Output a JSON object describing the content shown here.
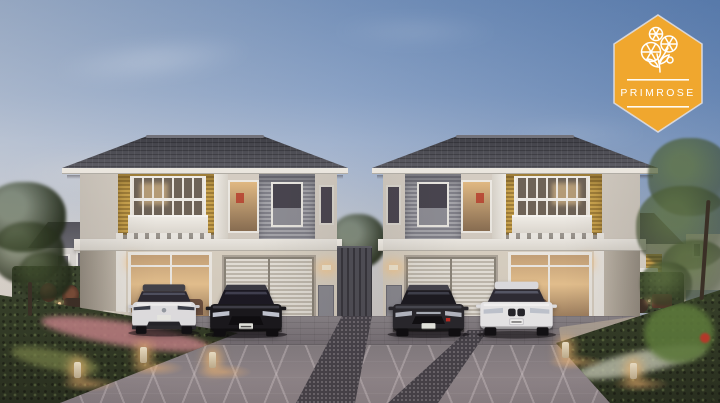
{
  "badge": {
    "label": "PRIMROSE",
    "icon": "primrose-flower-icon",
    "shape": "hexagon",
    "colors": {
      "background": "#F0A72E",
      "border": "#DADADF",
      "text": "#FFFFFF",
      "artwork": "#FFFFFF"
    }
  },
  "scene": {
    "description": "Dusk architectural rendering of twin two-storey houses with warmly lit interiors, four cars parked in front, patterned driveway, landscaped garden beds with glowing bollard lights and trees at both edges.",
    "houses": {
      "count": 2,
      "style": "hip roof, yellow slat balcony accent, grey slat panels, white trims"
    },
    "cars": [
      {
        "name": "white-crossover-suv",
        "body_color": "#E9E9EC"
      },
      {
        "name": "black-sedan",
        "body_color": "#1A1A1F"
      },
      {
        "name": "graphite-sedan",
        "body_color": "#27272C"
      },
      {
        "name": "white-luxury-sedan",
        "body_color": "#F1F1F3"
      }
    ],
    "lights": {
      "bollard_count": 5,
      "glow_color": "#FFBE78"
    },
    "palette": {
      "sky_top_right": "#5780B5",
      "sky_top_left": "#A9BAD5",
      "sky_horizon": "#DDD3CA",
      "roof": "#4B4B52",
      "wall_upper": "#D6CFC5",
      "wall_lower": "#DDD5C7",
      "accent_yellow": "#C5A252",
      "slat_grey": "#97979D",
      "window_frame": "#F2EFE9",
      "warm_interior_light": "#E9C48F",
      "pavement": "#8C8389",
      "pebble_strip": "#46434B",
      "foliage": "#3A4A2E"
    }
  }
}
